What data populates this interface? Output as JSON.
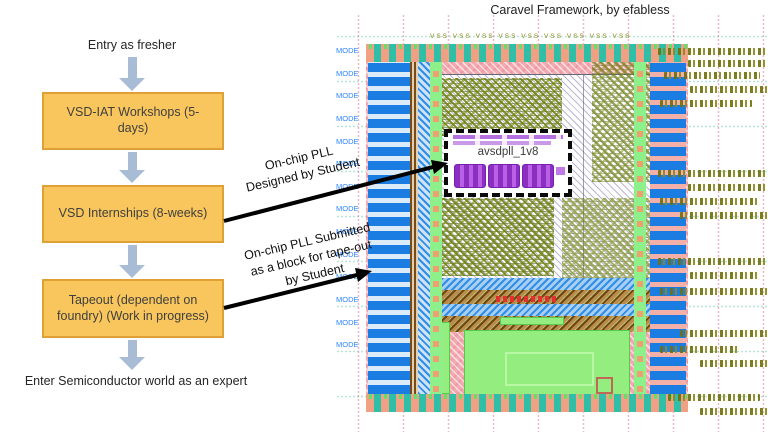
{
  "title": "Caravel Framework, by efabless",
  "flowchart": {
    "start_label": "Entry as fresher",
    "steps": [
      {
        "label": "VSD-IAT Workshops (5-days)"
      },
      {
        "label": "VSD Internships (8-weeks)"
      },
      {
        "label": "Tapeout (dependent on foundry) (Work in progress)"
      }
    ],
    "end_label": "Enter Semiconductor world as an expert",
    "box_fill": "#F8C65C",
    "box_border": "#DFA136",
    "arrow_color": "#A9BCD6"
  },
  "annotations": {
    "designed_arrow_label": "On-chip PLL\nDesigned by Student",
    "submitted_arrow_label": "On-chip PLL Submitted\nas a block for tape-out\nby Student",
    "arrow_color": "#000000"
  },
  "chip": {
    "block_label": "avsdpll_1v8",
    "left_pad_label": "MODE",
    "left_pad_count": 14,
    "top_rail_label": "VSS VSS VSS VSS VSS VSS VSS VSS VSS",
    "colors": {
      "ring_teal": "#2FBFA6",
      "pad_blue": "#1B7DE2",
      "pad_salmon": "#F0A184",
      "strip_green": "#8DF08A",
      "hatch_pink": "#F2AAB0",
      "block_purple": "#9A3AD0",
      "noise_olive": "#70700E",
      "macro_green": "#93EE7F"
    }
  }
}
